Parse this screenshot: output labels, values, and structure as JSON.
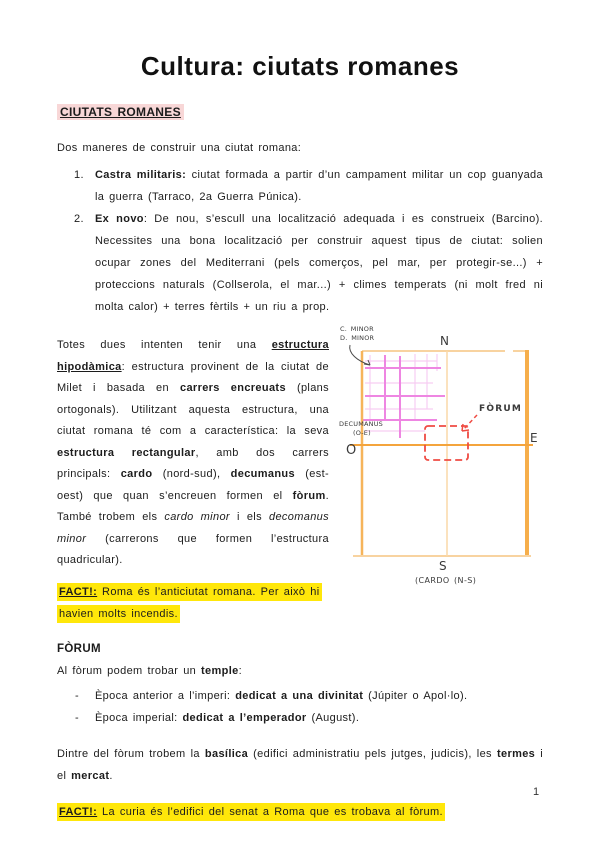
{
  "page": {
    "title": "Cultura: ciutats romanes",
    "page_number": "1"
  },
  "heading": "CIUTATS ROMANES",
  "intro": "Dos maneres de construir una ciutat romana:",
  "list": [
    {
      "num": "1.",
      "term": "Castra militaris:",
      "text": " ciutat formada a partir d’un campament militar un cop guanyada la guerra (Tarraco, 2a Guerra Púnica)."
    },
    {
      "num": "2.",
      "term": "Ex novo",
      "text": ": De nou, s’escull una localització adequada i es construeix (Barcino). Necessites una bona localització per construir aquest tipus de ciutat: solien ocupar zones del Mediterrani (pels comerços, pel mar, per protegir-se...) + proteccions naturals (Collserola, el mar...) + climes temperats (ni molt fred ni molta calor) + terres fèrtils + un riu a prop."
    }
  ],
  "hipodamic": {
    "s1": "Totes dues intenten tenir una ",
    "s2": "estructura hipodàmica",
    "s3": ": estructura provinent de la ciutat de Milet i basada en ",
    "s4": "carrers encreuats",
    "s5": " (plans ortogonals). Utilitzant aquesta estructura, una ciutat romana té com a característica: la seva ",
    "s6": "estructura rectangular",
    "s7": ", amb dos carrers principals: ",
    "s8": "cardo",
    "s9": " (nord-sud), ",
    "s10": "decumanus",
    "s11": " (est-oest) que quan s’encreuen formen el ",
    "s12": "fòrum",
    "s13": ". També trobem els ",
    "s14": "cardo minor",
    "s15": " i els ",
    "s16": "decomanus minor",
    "s17": " (carrerons que formen l’estructura quadricular)."
  },
  "fact1": {
    "label": "FACT!:",
    "text": " Roma és l’anticiutat romana. Per això hi havien molts incendis."
  },
  "forum": {
    "heading": "FÒRUM",
    "intro": {
      "pre": "Al fòrum podem trobar un ",
      "bold": "temple",
      "post": ":"
    },
    "bullets": [
      {
        "dash": "-",
        "pre": "Època anterior a l’imperi: ",
        "bold": "dedicat a una divinitat",
        "post": " (Júpiter o Apol·lo)."
      },
      {
        "dash": "-",
        "pre": "Època imperial: ",
        "bold": "dedicat a l’emperador",
        "post": " (August)."
      }
    ],
    "basilica": {
      "s1": "Dintre del fòrum trobem la ",
      "s2": "basílica",
      "s3": " (edifici administratiu pels jutges, judicis), les ",
      "s4": "termes",
      "s5": " i el ",
      "s6": "mercat",
      "s7": "."
    },
    "fact2": {
      "label": "FACT!:",
      "text": " La curia és l’edifici del senat a Roma que es trobava al fòrum."
    }
  },
  "diagram": {
    "north": "N",
    "south": "S",
    "east": "E",
    "west": "O",
    "cardo_label": "(CARDO (N-S)",
    "decumanus_label": "DECUMANUS",
    "decumanus_sub": "(O-E)",
    "minor_line1": "C. MINOR",
    "minor_line2": "D. MINOR",
    "forum_label": "FÒRUM"
  },
  "colors": {
    "pink_highlight": "#f8d7d7",
    "yellow_highlight": "#ffe70a",
    "wall_orange": "#f4a43c",
    "wall_orange_light": "#f8d3a0",
    "grid_magenta": "#ee86e2",
    "grid_pink_light": "#f7cdf2",
    "forum_red": "#ef4b43"
  }
}
